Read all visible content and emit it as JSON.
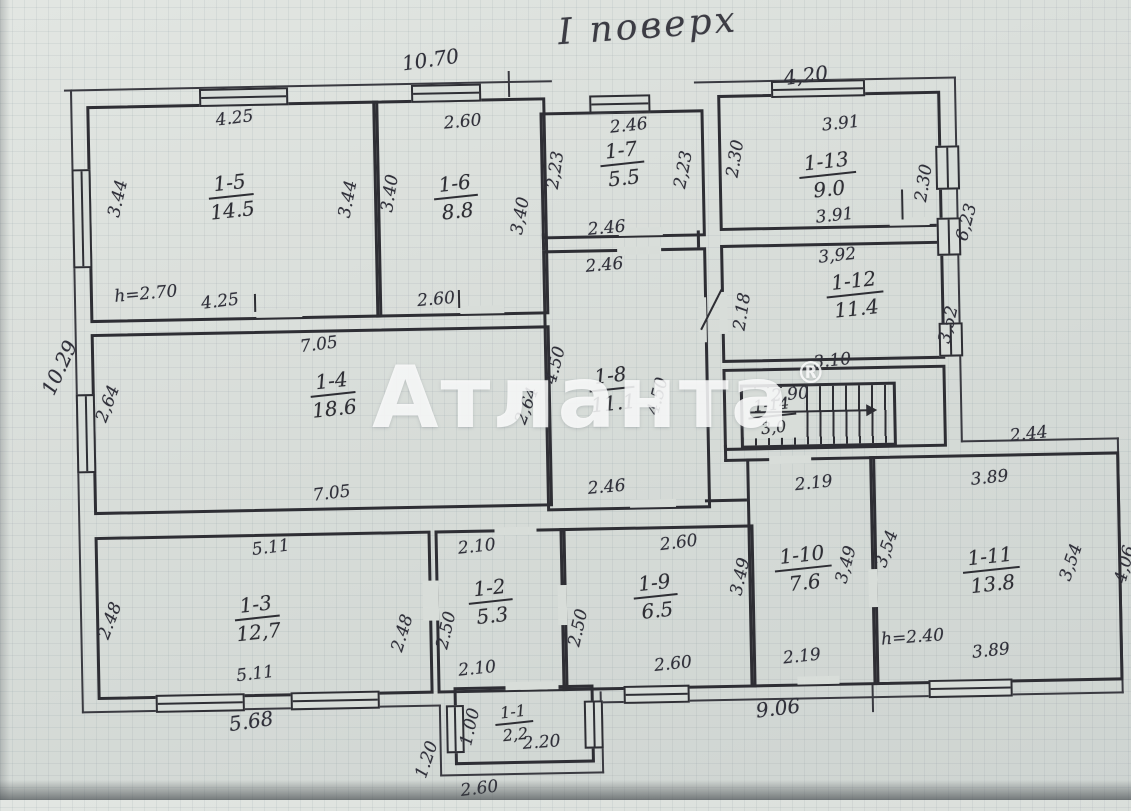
{
  "title": "І поверх",
  "watermark": {
    "text": "Атланта",
    "reg": "®"
  },
  "colors": {
    "paper": "#d8ddd9",
    "ink": "#2e2e34",
    "watermark": "#ffffff"
  },
  "rooms": {
    "r1": {
      "num": "1-1",
      "area": "2,2"
    },
    "r2": {
      "num": "1-2",
      "area": "5.3"
    },
    "r3": {
      "num": "1-3",
      "area": "12,7"
    },
    "r4": {
      "num": "1-4",
      "area": "18.6"
    },
    "r5": {
      "num": "1-5",
      "area": "14.5"
    },
    "r6": {
      "num": "1-6",
      "area": "8.8"
    },
    "r7": {
      "num": "1-7",
      "area": "5.5"
    },
    "r8": {
      "num": "1-8",
      "area": "11.1"
    },
    "r9": {
      "num": "1-9",
      "area": "6.5"
    },
    "r10": {
      "num": "1-10",
      "area": "7.6"
    },
    "r11": {
      "num": "1-11",
      "area": "13.8"
    },
    "r12": {
      "num": "1-12",
      "area": "11.4"
    },
    "r13": {
      "num": "1-13",
      "area": "9.0"
    },
    "r14": {
      "num": "1-14",
      "area": "3,0"
    }
  },
  "dims": {
    "outer_top_left": "10.70",
    "outer_top_right": "4,20",
    "outer_left": "10.29",
    "outer_right_upper": "6,23",
    "outer_right_lower": "4,06",
    "outer_bottom_left": "5.68",
    "outer_bottom_right": "9.06",
    "r5_top": "4.25",
    "r5_bottom": "4.25",
    "r5_left": "3.44",
    "r5_right": "3.44",
    "r5_h": "h=2.70",
    "r6_top": "2.60",
    "r6_bottom": "2.60",
    "r6_left": "3.40",
    "r6_right": "3,40",
    "r7_top": "2.46",
    "r7_bottom": "2.46",
    "r7_left": "2,23",
    "r7_right": "2,23",
    "r8_top": "2.46",
    "r8_bottom": "2.46",
    "r8_left": "4.50",
    "r8_right": "4.50",
    "r13_top": "3.91",
    "r13_bottom": "3.91",
    "r13_left": "2.30",
    "r13_right": "2.30",
    "r12_top": "3,92",
    "r12_bottom": "3.10",
    "r12_left": "2.18",
    "r12_right": "3,52",
    "r14_top": "2.90",
    "r4_top": "7.05",
    "r4_bottom": "7.05",
    "r4_left": "2,64",
    "r4_right": "2,64",
    "r3_top": "5.11",
    "r3_bottom": "5.11",
    "r3_left": "2.48",
    "r3_right": "2.48",
    "r2_top": "2.10",
    "r2_bottom": "2.10",
    "r2_left": "2.50",
    "r9_top": "2.60",
    "r9_bottom": "2.60",
    "r9_left": "2.50",
    "r10_top": "2.19",
    "r10_bottom": "2.19",
    "r10_left": "3.49",
    "r10_right": "3,49",
    "r11_top": "3.89",
    "r11_bottom": "3.89",
    "r11_left": "3,54",
    "r11_right": "3,54",
    "r11_h": "h=2.40",
    "r11_top_right": "2.44",
    "r1_left": "1.00",
    "r1_inner": "2.20",
    "r1_outer_left": "1.20",
    "r1_bottom": "2.60"
  }
}
